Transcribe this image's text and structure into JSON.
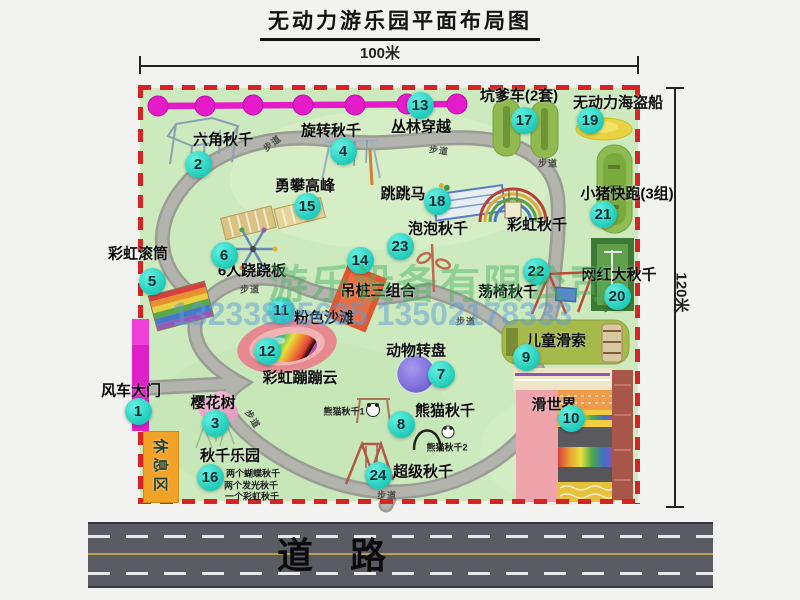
{
  "title": "无动力游乐园平面布局图",
  "dim_top": "100米",
  "dim_right": "120米",
  "road": "道路",
  "rest_area": "休息区",
  "watermark_company": "游乐设备有限公司",
  "watermark_phone": "13233805635 13502178333",
  "colors": {
    "boundary_dash": "#d62424",
    "park_green": "#cdeabf",
    "marker_cyan": "#1fc9b8",
    "gate_magenta": "#df1fc8",
    "zipline_magenta": "#e31bc9",
    "rest_area_orange": "#f2a327",
    "road_gray": "#5b5b64"
  },
  "attractions": [
    {
      "num": "1",
      "label": "风车大门",
      "nx": 138,
      "ny": 411,
      "lx": 131,
      "ly": 390
    },
    {
      "num": "2",
      "label": "六角秋千",
      "nx": 198,
      "ny": 164,
      "lx": 223,
      "ly": 139
    },
    {
      "num": "3",
      "label": "樱花树",
      "nx": 215,
      "ny": 423,
      "lx": 213,
      "ly": 402
    },
    {
      "num": "4",
      "label": "旋转秋千",
      "nx": 343,
      "ny": 151,
      "lx": 331,
      "ly": 130
    },
    {
      "num": "5",
      "label": "彩虹滚筒",
      "nx": 152,
      "ny": 281,
      "lx": 138,
      "ly": 253
    },
    {
      "num": "6",
      "label": "6人跷跷板",
      "nx": 224,
      "ny": 255,
      "lx": 252,
      "ly": 270
    },
    {
      "num": "7",
      "label": "动物转盘",
      "nx": 441,
      "ny": 374,
      "lx": 416,
      "ly": 350
    },
    {
      "num": "8",
      "label": "熊猫秋千",
      "nx": 401,
      "ny": 424,
      "lx": 445,
      "ly": 410
    },
    {
      "num": "9",
      "label": "儿童滑索",
      "nx": 526,
      "ny": 357,
      "lx": 556,
      "ly": 340
    },
    {
      "num": "10",
      "label": "滑世界",
      "nx": 571,
      "ny": 418,
      "lx": 554,
      "ly": 404
    },
    {
      "num": "11",
      "label": "粉色沙滩",
      "nx": 281,
      "ny": 310,
      "lx": 324,
      "ly": 317
    },
    {
      "num": "12",
      "label": "彩虹蹦蹦云",
      "nx": 267,
      "ny": 351,
      "lx": 300,
      "ly": 377
    },
    {
      "num": "13",
      "label": "丛林穿越",
      "nx": 420,
      "ny": 105,
      "lx": 421,
      "ly": 126
    },
    {
      "num": "14",
      "label": "吊桩三组合",
      "nx": 360,
      "ny": 260,
      "lx": 378,
      "ly": 290
    },
    {
      "num": "15",
      "label": "勇攀高峰",
      "nx": 307,
      "ny": 206,
      "lx": 305,
      "ly": 185
    },
    {
      "num": "16",
      "label": "秋千乐园",
      "nx": 210,
      "ny": 477,
      "lx": 230,
      "ly": 455
    },
    {
      "num": "17",
      "label": "坑爹车(2套)",
      "nx": 524,
      "ny": 120,
      "lx": 519,
      "ly": 95
    },
    {
      "num": "18",
      "label": "跳跳马",
      "nx": 437,
      "ny": 201,
      "lx": 403,
      "ly": 193
    },
    {
      "num": "19",
      "label": "无动力海盗船",
      "nx": 590,
      "ny": 120,
      "lx": 618,
      "ly": 102
    },
    {
      "num": "20",
      "label": "网红大秋千",
      "nx": 617,
      "ny": 296,
      "lx": 619,
      "ly": 274
    },
    {
      "num": "21",
      "label": "小猪快跑(3组)",
      "nx": 603,
      "ny": 214,
      "lx": 627,
      "ly": 193
    },
    {
      "num": "22",
      "label": "荡椅秋千",
      "nx": 536,
      "ny": 271,
      "lx": 508,
      "ly": 291
    },
    {
      "num": "23",
      "label": "泡泡秋千",
      "nx": 400,
      "ny": 246,
      "lx": 438,
      "ly": 228
    },
    {
      "num": "24",
      "label": "超级秋千",
      "nx": 378,
      "ny": 475,
      "lx": 423,
      "ly": 471
    },
    {
      "num": null,
      "label": "彩虹秋千",
      "lx": 537,
      "ly": 224
    }
  ],
  "sub_labels": [
    {
      "text": "熊猫秋千1",
      "x": 344,
      "y": 411
    },
    {
      "text": "熊猫秋千2",
      "x": 447,
      "y": 447
    },
    {
      "text": "两个蝴蝶秋千",
      "x": 253,
      "y": 473
    },
    {
      "text": "两个发光秋千",
      "x": 251,
      "y": 485
    },
    {
      "text": "一个彩虹秋千",
      "x": 252,
      "y": 496
    }
  ],
  "path_labels": [
    {
      "text": "步道",
      "x": 272,
      "y": 143,
      "rot": -38
    },
    {
      "text": "步道",
      "x": 439,
      "y": 150,
      "rot": 8
    },
    {
      "text": "步道",
      "x": 548,
      "y": 163,
      "rot": 0
    },
    {
      "text": "步道",
      "x": 250,
      "y": 289,
      "rot": 0
    },
    {
      "text": "步道",
      "x": 253,
      "y": 419,
      "rot": 58
    },
    {
      "text": "步道",
      "x": 466,
      "y": 321,
      "rot": 0
    },
    {
      "text": "步道",
      "x": 387,
      "y": 495,
      "rot": 0
    }
  ]
}
